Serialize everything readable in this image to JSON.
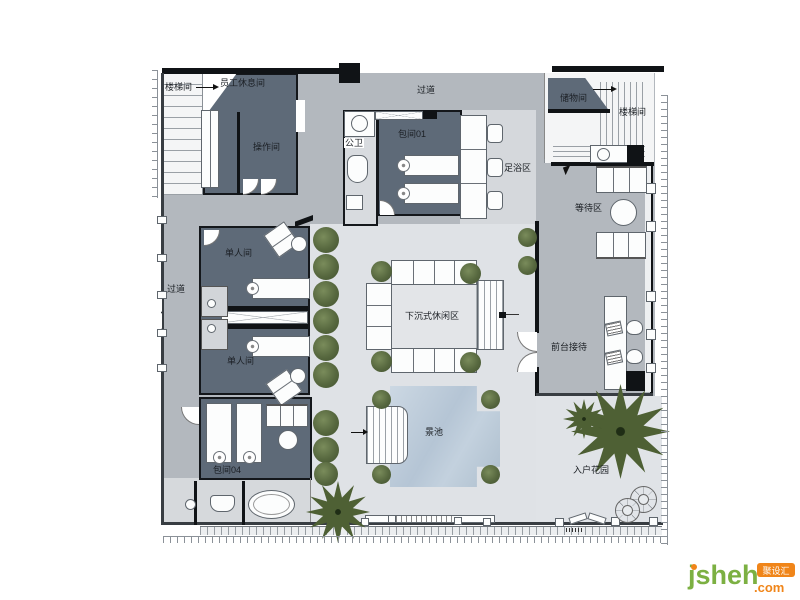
{
  "plan": {
    "rooms": {
      "stairwell_top_left": "楼梯间",
      "staff_lounge": "员工休息间",
      "operation_room": "操作间",
      "corridor_top": "过道",
      "public_toilet": "公卫",
      "private_room_01": "包间01",
      "foot_bath_area": "足浴区",
      "storage_room": "储物间",
      "stairwell_top_right": "楼梯间",
      "waiting_area": "等待区",
      "single_room_upper": "单人间",
      "corridor_left": "过道",
      "single_room_lower": "单人间",
      "sunken_lounge": "下沉式休闲区",
      "reception": "前台接待",
      "private_room_04": "包间04",
      "scenic_pool": "景池",
      "entry_garden": "入户花园"
    },
    "colors": {
      "dark_room": "#5e6a78",
      "corridor": "#b3b8be",
      "courtyard": "#dfe2e6",
      "pool": "#bfcedd",
      "plant": "#4e6034",
      "wall": "#101316"
    }
  },
  "watermark": {
    "brand": "jsheh",
    "tld": ".com",
    "badge": "聚设汇"
  }
}
